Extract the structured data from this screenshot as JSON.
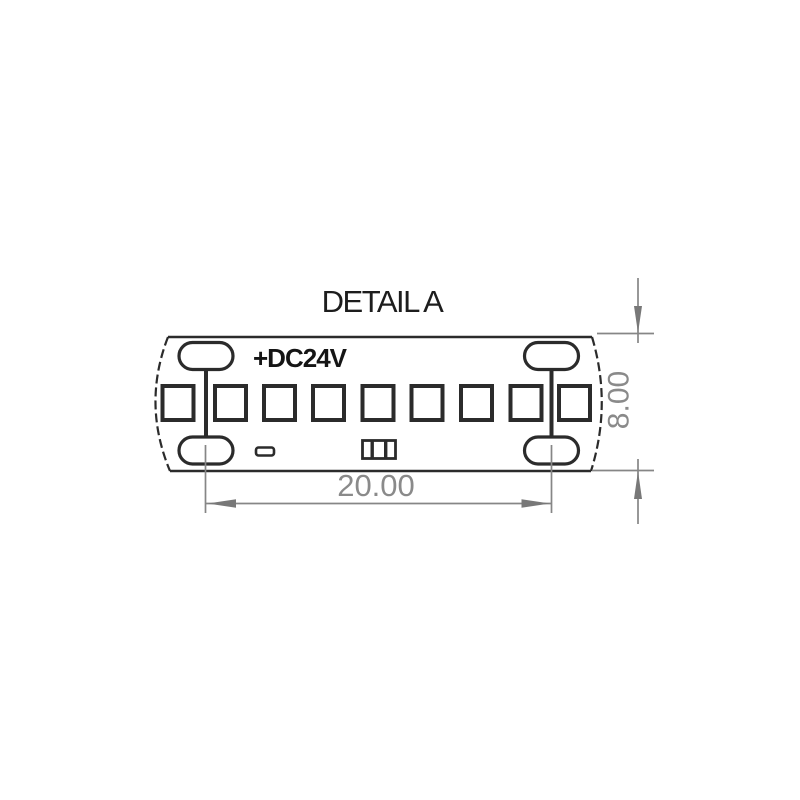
{
  "title": "DETAIL A",
  "strip": {
    "polarity_label": "+DC24V",
    "led_count": 9
  },
  "dimensions": {
    "width_label": "20.00",
    "height_label": "8.00"
  },
  "colors": {
    "drawing_line": "#2b2b2b",
    "dimension_gray": "#8a8a8a",
    "background": "#ffffff"
  }
}
